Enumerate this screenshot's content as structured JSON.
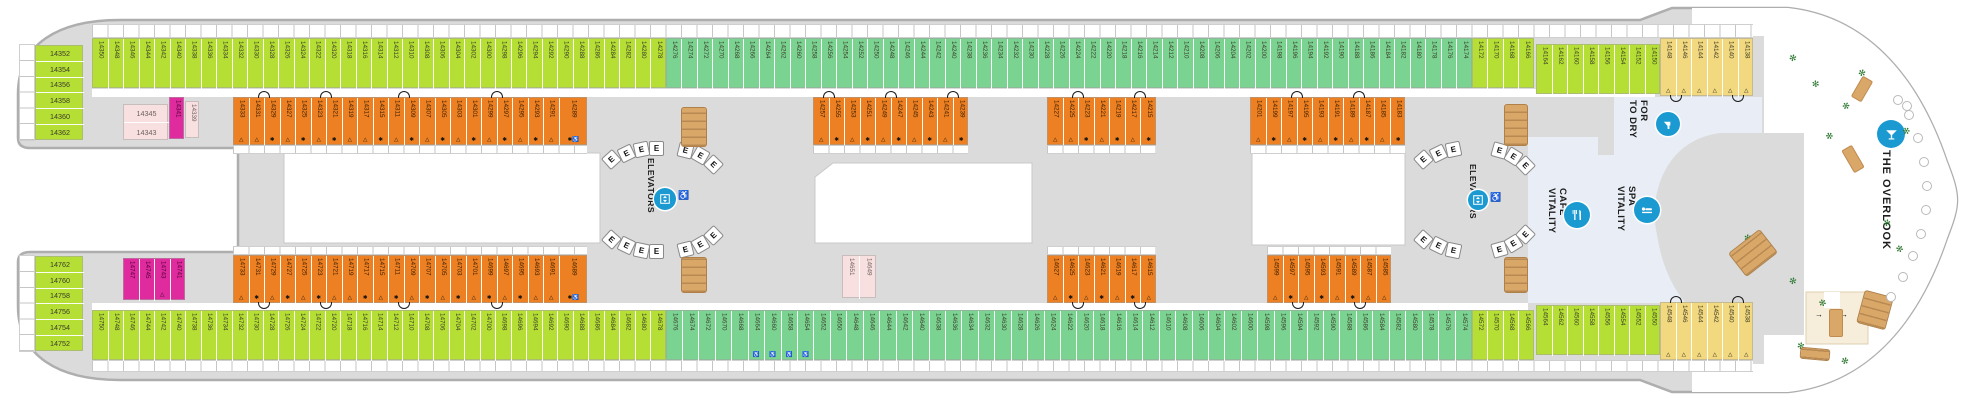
{
  "labels": {
    "elevators": "ELEVATORS",
    "elevator_box": "E",
    "to_dry_for": [
      "TO DRY",
      "FOR"
    ],
    "vitality_spa": [
      "VITALITY",
      "SPA"
    ],
    "vitality_cafe": [
      "VITALITY",
      "CAFE"
    ],
    "overlook": "THE OVERLOOK"
  },
  "colors": {
    "l": "#b5df35",
    "m": "#7bd392",
    "o": "#ec8022",
    "p": "#f7e0df",
    "f": "#e02b9e",
    "n": "#f2d87e",
    "deck_gray": "#dbdbdb",
    "hull_stroke": "#aeaeae",
    "spa_blue": "#e9eef6",
    "icon_blue": "#1b9ad2",
    "restroom_cream": "#f6eedb",
    "stair_tan": "#d9a869"
  },
  "symbols": {
    "t": "△",
    "s": "✱",
    "w": "♿",
    "sw": "✱♿"
  },
  "decor": {
    "restroom_arrow": "→",
    "plant_glyph": "✻"
  },
  "cabins": {
    "topA": [
      "14350",
      "14348",
      "14346",
      "14344",
      "14342",
      "14340",
      "14338",
      "14336",
      "14334",
      "14332",
      "14330",
      "14328",
      "14326",
      "14324",
      "14322",
      "14320",
      "14318",
      "14316",
      "14314",
      "14312",
      "14310",
      "14308",
      "14306",
      "14304",
      "14302",
      "14300",
      "14298",
      "14296",
      "14294",
      "14292",
      "14290",
      "14288",
      "14286",
      "14284",
      "14282",
      "14280",
      "14278"
    ],
    "topB": [
      "14276",
      "14274",
      "14272",
      "14270",
      "14268",
      "14266",
      "14264",
      "14262",
      "14260",
      "14258",
      "14256",
      "14254",
      "14252",
      "14250",
      "14248",
      "14246",
      "14244",
      "14242",
      "14240",
      "14238",
      "14236",
      "14234",
      "14232",
      "14230",
      "14228",
      "14226",
      "14224",
      "14222",
      "14220",
      "14218",
      "14216",
      "14214",
      "14212",
      "14210",
      "14208",
      "14206",
      "14204",
      "14202",
      "14200",
      "14198",
      "14196",
      "14194",
      "14192",
      "14190",
      "14188",
      "14186",
      "14184",
      "14182",
      "14180",
      "14178",
      "14176",
      "14174"
    ],
    "topC": [
      "14172",
      "14170",
      "14168",
      "14166"
    ],
    "topD": [
      "14164",
      "14162",
      "14160",
      "14158",
      "14156",
      "14154",
      "14152",
      "14150"
    ],
    "topE": [
      "14148 t",
      "14146 t",
      "14144 t",
      "14142 t",
      "14140 t",
      "14138 t"
    ],
    "botA": [
      "14750",
      "14748",
      "14746",
      "14744",
      "14742",
      "14740",
      "14738",
      "14736",
      "14734",
      "14732",
      "14730",
      "14728",
      "14726",
      "14724",
      "14722",
      "14720",
      "14718",
      "14716",
      "14714",
      "14712",
      "14710",
      "14708",
      "14706",
      "14704",
      "14702",
      "14700",
      "14698",
      "14696",
      "14694",
      "14692",
      "14690",
      "14688",
      "14686",
      "14684",
      "14682",
      "14680",
      "14678"
    ],
    "botB": [
      "14676",
      "14674",
      "14672",
      "14670",
      "14668",
      "14664 w",
      "14660 w",
      "14658 w",
      "14654 w",
      "14652",
      "14650",
      "14648",
      "14646",
      "14644",
      "14642",
      "14640",
      "14638",
      "14636",
      "14634",
      "14632",
      "14630",
      "14628",
      "14626",
      "14624",
      "14622",
      "14620",
      "14618",
      "14616",
      "14614",
      "14612",
      "14610",
      "14608",
      "14606",
      "14604",
      "14602",
      "14600",
      "14598",
      "14596",
      "14594",
      "14592",
      "14590",
      "14588",
      "14586",
      "14584",
      "14582",
      "14580",
      "14578",
      "14576",
      "14574"
    ],
    "botC": [
      "14572",
      "14570",
      "14568",
      "14566"
    ],
    "botD": [
      "14564",
      "14562",
      "14560",
      "14558",
      "14556",
      "14554",
      "14552",
      "14550"
    ],
    "botE": [
      "14548 t",
      "14546 t",
      "14544 t",
      "14542 t",
      "14540 t",
      "14538 t"
    ],
    "aftTop": [
      "14352",
      "14354",
      "14356",
      "14358",
      "14360",
      "14362"
    ],
    "aftBot": [
      "14762",
      "14760",
      "14758",
      "14756",
      "14754",
      "14752"
    ],
    "oT1": [
      "14333 t",
      "14331 t",
      "14329 s",
      "14327 t",
      "14325 s",
      "14323 t",
      "14321 s",
      "14319 t",
      "14317 t",
      "14315 s",
      "14311 t",
      "14309 s",
      "14307 t",
      "14305 s",
      "14303 t",
      "14301 s",
      "14299 t",
      "14297 s",
      "14295 t",
      "14293 s",
      "14291 t",
      "14289 sw"
    ],
    "oT2": [
      "14257 t",
      "14255 s",
      "14253 t",
      "14251 s",
      "14249 t",
      "14247 s",
      "14245 t",
      "14243 s",
      "14241 t",
      "14239 s"
    ],
    "oT3": [
      "14227 t",
      "14225 t",
      "14223 s",
      "14221 t",
      "14219 s",
      "14217 t",
      "14215 s"
    ],
    "oT4": [
      "14201 t",
      "14199 s",
      "14197 t",
      "14195 s",
      "14193 t",
      "14191 s",
      "14189 t",
      "14187 s",
      "14185 t",
      "14183 s"
    ],
    "oB1": [
      "14733 t",
      "14731 s",
      "14729 t",
      "14727 s",
      "14725 t",
      "14723 s",
      "14721 t",
      "14719 t",
      "14717 s",
      "14715 t",
      "14711 s",
      "14709 t",
      "14707 s",
      "14705 t",
      "14703 s",
      "14701 t",
      "14699 s",
      "14697 t",
      "14695 s",
      "14693 t",
      "14691 t",
      "14689 sw"
    ],
    "oB2": [
      "14627 t",
      "14625 s",
      "14623 t",
      "14621 s",
      "14619 t",
      "14617 s",
      "14615 t"
    ],
    "oB3": [
      "14599 t",
      "14597 s",
      "14595 t",
      "14593 s",
      "14591 t",
      "14589 s",
      "14587 t",
      "14585 t"
    ],
    "m341": [
      "14341"
    ],
    "p339": [
      "14339"
    ],
    "pTop": [
      "14345",
      "14343"
    ],
    "mBot": [
      "14747",
      "14745",
      "14743 t",
      "14741"
    ],
    "pMid": [
      "14651",
      "14649"
    ]
  }
}
